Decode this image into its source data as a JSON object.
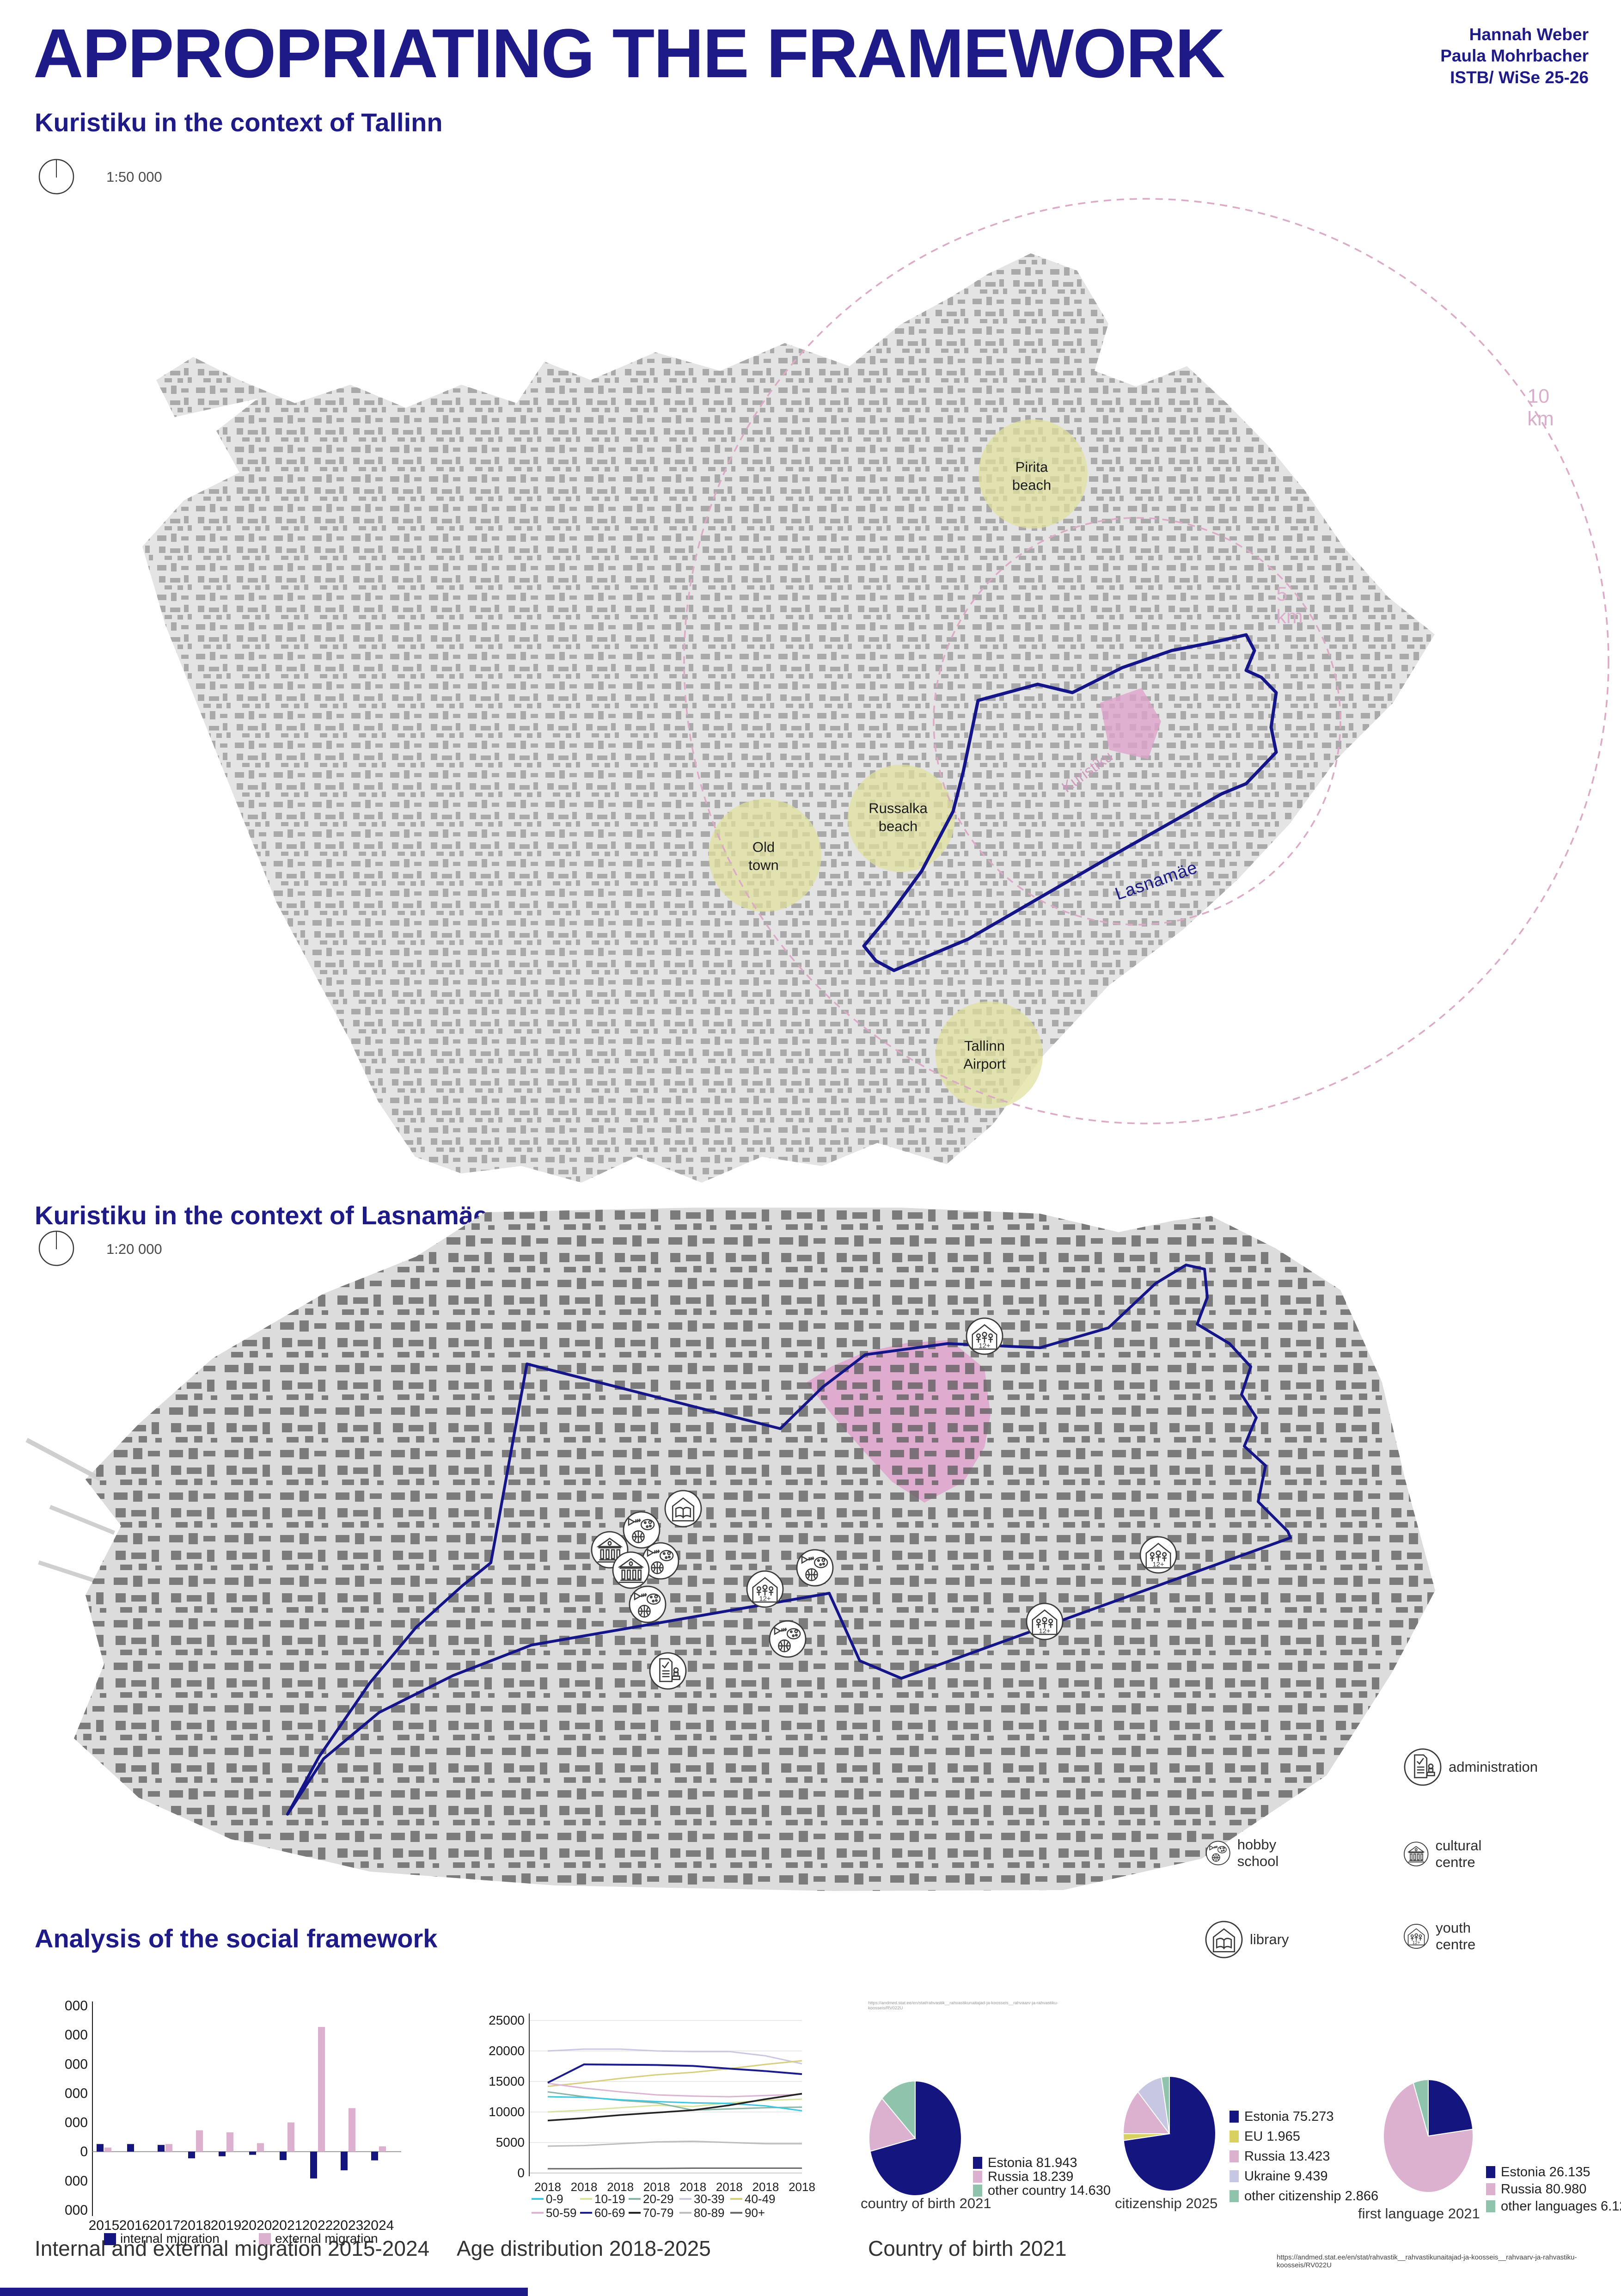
{
  "header": {
    "title": "APPROPRIATING THE FRAMEWORK",
    "authors": [
      "Hannah Weber",
      "Paula Mohrbacher",
      "ISTB/ WiSe 25-26"
    ]
  },
  "section_tallinn": {
    "heading": "Kuristiku in the context of Tallinn",
    "scale_label": "1:50 000"
  },
  "section_lasnamae": {
    "heading": "Kuristiku in the context of Lasnamäe",
    "scale_label": "1:20 000"
  },
  "section_analysis": {
    "heading": "Analysis of the social framework"
  },
  "map_tallinn": {
    "labels": {
      "pirita": "Pirita\nbeach",
      "russalka": "Russalka\nbeach",
      "old_town": "Old town",
      "airport": "Tallinn\nAirport",
      "kuristiku": "Kuristiku",
      "lasnamae": "Lasnamäe",
      "ring_5km": "5 km",
      "ring_10km": "10 km"
    }
  },
  "map_lasnamae": {
    "legend": [
      {
        "icon": "hobby-school",
        "label": "hobby school"
      },
      {
        "icon": "library",
        "label": "library"
      },
      {
        "icon": "administration",
        "label": "administration"
      },
      {
        "icon": "cultural-centre",
        "label": "cultural centre"
      },
      {
        "icon": "youth-centre",
        "label": "youth centre"
      }
    ]
  },
  "captions": {
    "migration": "Internal and external migration 2015-2024",
    "age": "Age distribution 2018-2025",
    "birth": "Country of birth 2021"
  },
  "source_url": "https://andmed.stat.ee/en/stat/rahvastik__rahvastikunaitajad-ja-koosseis__rahvaarv-ja-rahvastiku-koosseis/RV022U",
  "colors": {
    "navy": "#1e1a87",
    "boundary_navy": "#15158a",
    "bar_navy": "#15157f",
    "pink": "#dbb1cf",
    "area_pink": "#dfa3cc",
    "dash_pink": "#dcaac6",
    "area_yellow": "#e0e09c",
    "teal": "#8fc3ab",
    "eu_yellow": "#d8d060",
    "ukraine_lavender": "#c7c6e3",
    "land_gray": "#e4e4e4",
    "building_gray": "#6e6e6e"
  },
  "chart_data": [
    {
      "id": "migration",
      "type": "bar",
      "title": "Internal and external migration 2015-2024",
      "categories": [
        "2015",
        "2016",
        "2017",
        "2018",
        "2019",
        "2020",
        "2021",
        "2022",
        "2023",
        "2024"
      ],
      "series": [
        {
          "name": "internal migration",
          "color": "#15157f",
          "values": [
            260,
            260,
            230,
            -230,
            -160,
            -110,
            -290,
            -920,
            -640,
            -300
          ]
        },
        {
          "name": "external migration",
          "color": "#dbb1cf",
          "values": [
            140,
            0,
            260,
            730,
            660,
            290,
            1000,
            4270,
            1490,
            180
          ]
        }
      ],
      "ylim": [
        -2000,
        5000
      ],
      "ytick_step": 1000,
      "legend_position": "bottom",
      "grid": false
    },
    {
      "id": "age",
      "type": "line",
      "title": "Age distribution 2018-2025",
      "x_labels": [
        "2018",
        "2018",
        "2018",
        "2018",
        "2018",
        "2018",
        "2018",
        "2018"
      ],
      "ylim": [
        0,
        25000
      ],
      "ytick_step": 5000,
      "legend_position": "bottom",
      "grid": true,
      "series": [
        {
          "name": "0-9",
          "color": "#3fc8dd",
          "values": [
            12500,
            12400,
            12000,
            11700,
            11500,
            11400,
            11000,
            10200
          ]
        },
        {
          "name": "10-19",
          "color": "#d7e59e",
          "values": [
            10000,
            10300,
            10700,
            11100,
            10900,
            11500,
            11900,
            12100
          ]
        },
        {
          "name": "20-29",
          "color": "#8ab4a5",
          "values": [
            13300,
            12500,
            11900,
            11500,
            10300,
            10500,
            10700,
            10800
          ]
        },
        {
          "name": "30-39",
          "color": "#c9c7e4",
          "values": [
            20000,
            20300,
            20300,
            20000,
            19900,
            19900,
            19200,
            17900
          ]
        },
        {
          "name": "40-49",
          "color": "#d6cf7f",
          "values": [
            14200,
            14800,
            15500,
            16100,
            16500,
            17100,
            17800,
            18400
          ]
        },
        {
          "name": "50-59",
          "color": "#dcb3d0",
          "values": [
            14700,
            13900,
            13300,
            12800,
            12600,
            12500,
            12700,
            12900
          ]
        },
        {
          "name": "60-69",
          "color": "#1c1c8a",
          "values": [
            14800,
            17800,
            17750,
            17700,
            17550,
            17100,
            16700,
            16200
          ]
        },
        {
          "name": "70-79",
          "color": "#222222",
          "values": [
            8600,
            9000,
            9500,
            9900,
            10300,
            11100,
            12100,
            13000
          ]
        },
        {
          "name": "80-89",
          "color": "#bcbcbc",
          "values": [
            4400,
            4500,
            4800,
            5100,
            5200,
            5000,
            4800,
            4800
          ]
        },
        {
          "name": "90+",
          "color": "#6a6a6a",
          "values": [
            700,
            700,
            750,
            750,
            800,
            800,
            800,
            800
          ]
        }
      ]
    },
    {
      "id": "birth",
      "type": "pie",
      "title": "country of birth 2021",
      "slices": [
        {
          "label": "Estonia 81.943",
          "value": 81.943,
          "color": "#15157f"
        },
        {
          "label": "Russia 18.239",
          "value": 18.239,
          "color": "#dbb1cf"
        },
        {
          "label": "other country 14.630",
          "value": 14.63,
          "color": "#8fc3ab"
        }
      ]
    },
    {
      "id": "citizenship",
      "type": "pie",
      "title": "citizenship 2025",
      "slices": [
        {
          "label": "Estonia 75.273",
          "value": 75.273,
          "color": "#15157f"
        },
        {
          "label": "EU 1.965",
          "value": 1.965,
          "color": "#d8d060"
        },
        {
          "label": "Russia 13.423",
          "value": 13.423,
          "color": "#dbb1cf"
        },
        {
          "label": "Ukraine 9.439",
          "value": 9.439,
          "color": "#c7c6e3"
        },
        {
          "label": "other citizenship 2.866",
          "value": 2.866,
          "color": "#8fc3ab"
        }
      ]
    },
    {
      "id": "language",
      "type": "pie",
      "title": "first language 2021",
      "slices": [
        {
          "label": "Estonia 26.135",
          "value": 26.135,
          "color": "#15157f"
        },
        {
          "label": "Russia 80.980",
          "value": 80.98,
          "color": "#dbb1cf"
        },
        {
          "label": "other languages 6.123",
          "value": 6.123,
          "color": "#8fc3ab"
        }
      ]
    }
  ]
}
